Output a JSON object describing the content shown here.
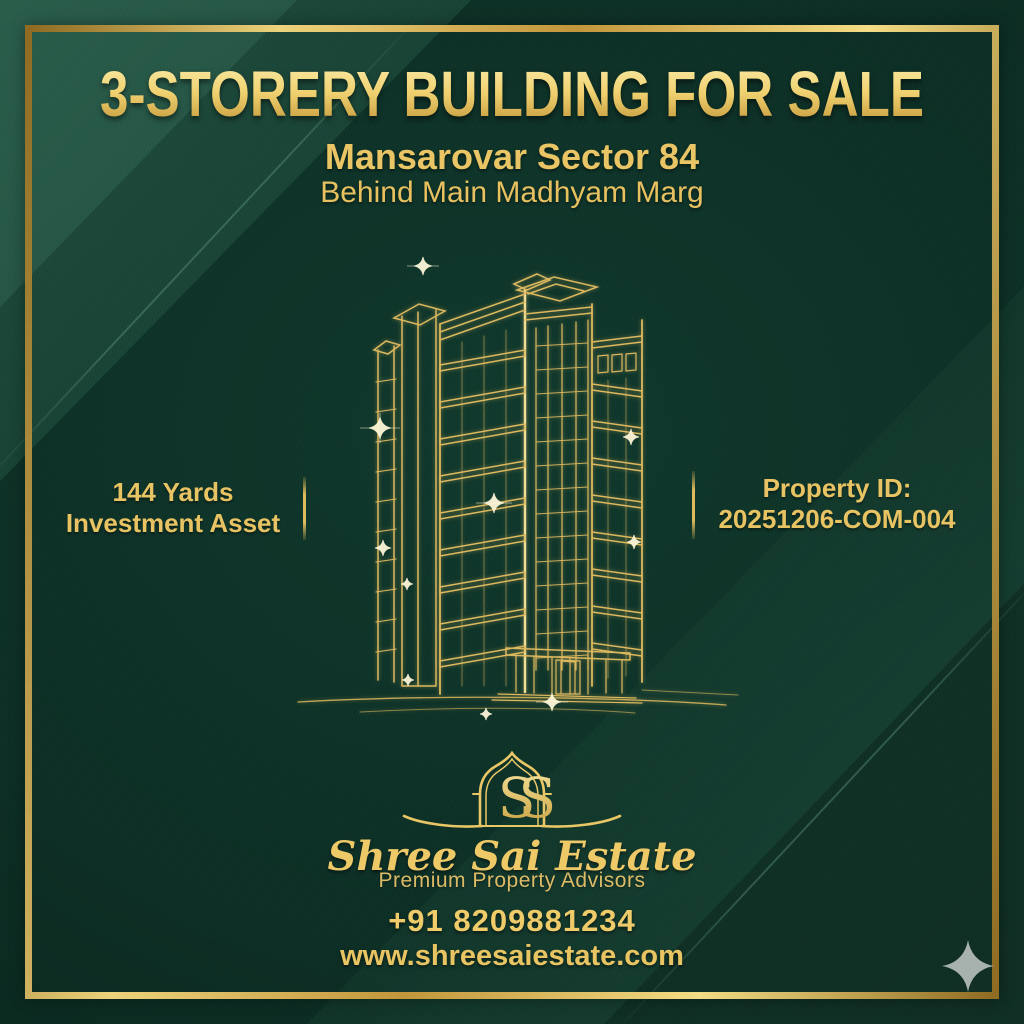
{
  "poster": {
    "title": "3-STORERY BUILDING FOR SALE",
    "location_line1": "Mansarovar Sector 84",
    "location_line2": "Behind Main Madhyam Marg",
    "stats": {
      "area": "144 Yards",
      "asset_type": "Investment Asset",
      "property_id_label": "Property ID:",
      "property_id_value": "20251206-COM-004"
    },
    "logo": {
      "monogram": "SS",
      "brand_name": "Shree Sai Estate",
      "tagline": "Premium Property Advisors"
    },
    "contact": {
      "phone": "+91 8209881234",
      "website": "www.shreesaiestate.com"
    },
    "icons": {
      "building": "gold-wireframe-building",
      "logo_arch": "mughal-arch-monogram",
      "corner_star": "four-point-sparkle"
    },
    "colors": {
      "background_green": "#0c2f25",
      "gold": "#e8c560",
      "gold_light": "#f6e195",
      "gold_deep": "#b98f35",
      "star_silver": "#a7b2ae"
    }
  }
}
